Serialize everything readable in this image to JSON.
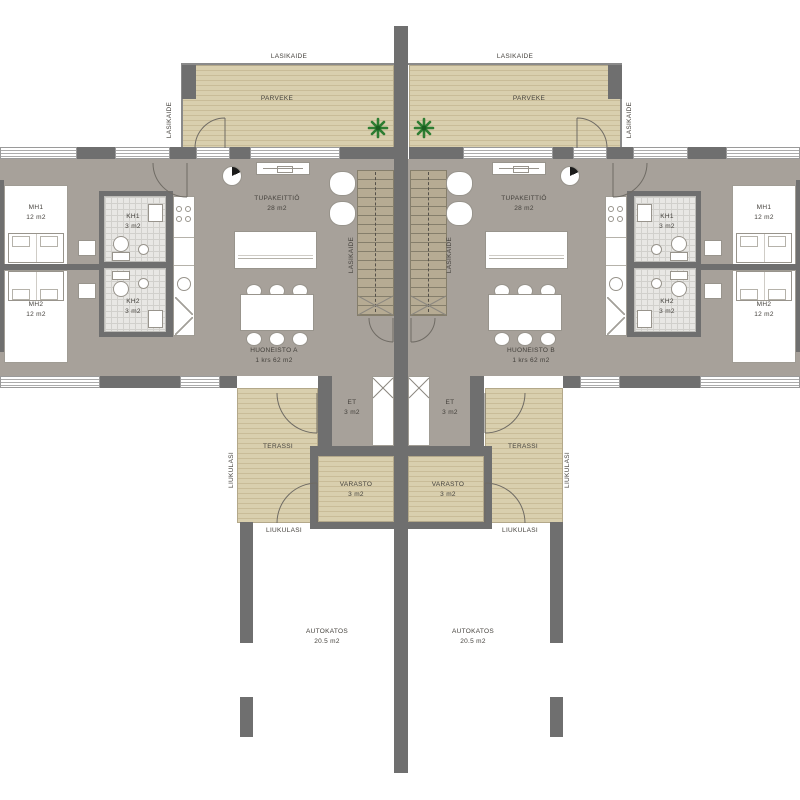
{
  "drawing_type": "floor-plan",
  "colors": {
    "wall": "#6f6f6f",
    "floor": "#a7a19a",
    "deck": "#d9cfae",
    "tile": "#e8e7e4",
    "plant": "#2e7d32",
    "text": "#44413c"
  },
  "balcony": {
    "name": "PARVEKE",
    "railing_label": "LASIKAIDE"
  },
  "stairs": {
    "railing_label": "LASIKAIDE"
  },
  "apartment_a": {
    "name": "HUONEISTO A",
    "floor_info": "1 krs 62 m2",
    "living": {
      "name": "TUPAKEITTIÖ",
      "area": "28 m2"
    },
    "bedroom1": {
      "name": "MH1",
      "area": "12 m2"
    },
    "bedroom2": {
      "name": "MH2",
      "area": "12 m2"
    },
    "bath1": {
      "name": "KH1",
      "area": "3 m2"
    },
    "bath2": {
      "name": "KH2",
      "area": "3 m2"
    },
    "entry": {
      "name": "ET",
      "area": "3 m2"
    },
    "terrace": {
      "name": "TERASSI",
      "sliding_glass_label": "LIUKULASI"
    },
    "storage": {
      "name": "VARASTO",
      "area": "3 m2"
    },
    "carport": {
      "name": "AUTOKATOS",
      "area": "20.5 m2"
    }
  },
  "apartment_b": {
    "name": "HUONEISTO B",
    "floor_info": "1 krs 62 m2",
    "living": {
      "name": "TUPAKEITTIÖ",
      "area": "28 m2"
    },
    "bedroom1": {
      "name": "MH1",
      "area": "12 m2"
    },
    "bedroom2": {
      "name": "MH2",
      "area": "12 m2"
    },
    "bath1": {
      "name": "KH1",
      "area": "3 m2"
    },
    "bath2": {
      "name": "KH2",
      "area": "3 m2"
    },
    "entry": {
      "name": "ET",
      "area": "3 m2"
    },
    "terrace": {
      "name": "TERASSI",
      "sliding_glass_label": "LIUKULASI"
    },
    "storage": {
      "name": "VARASTO",
      "area": "3 m2"
    },
    "carport": {
      "name": "AUTOKATOS",
      "area": "20.5 m2"
    }
  }
}
